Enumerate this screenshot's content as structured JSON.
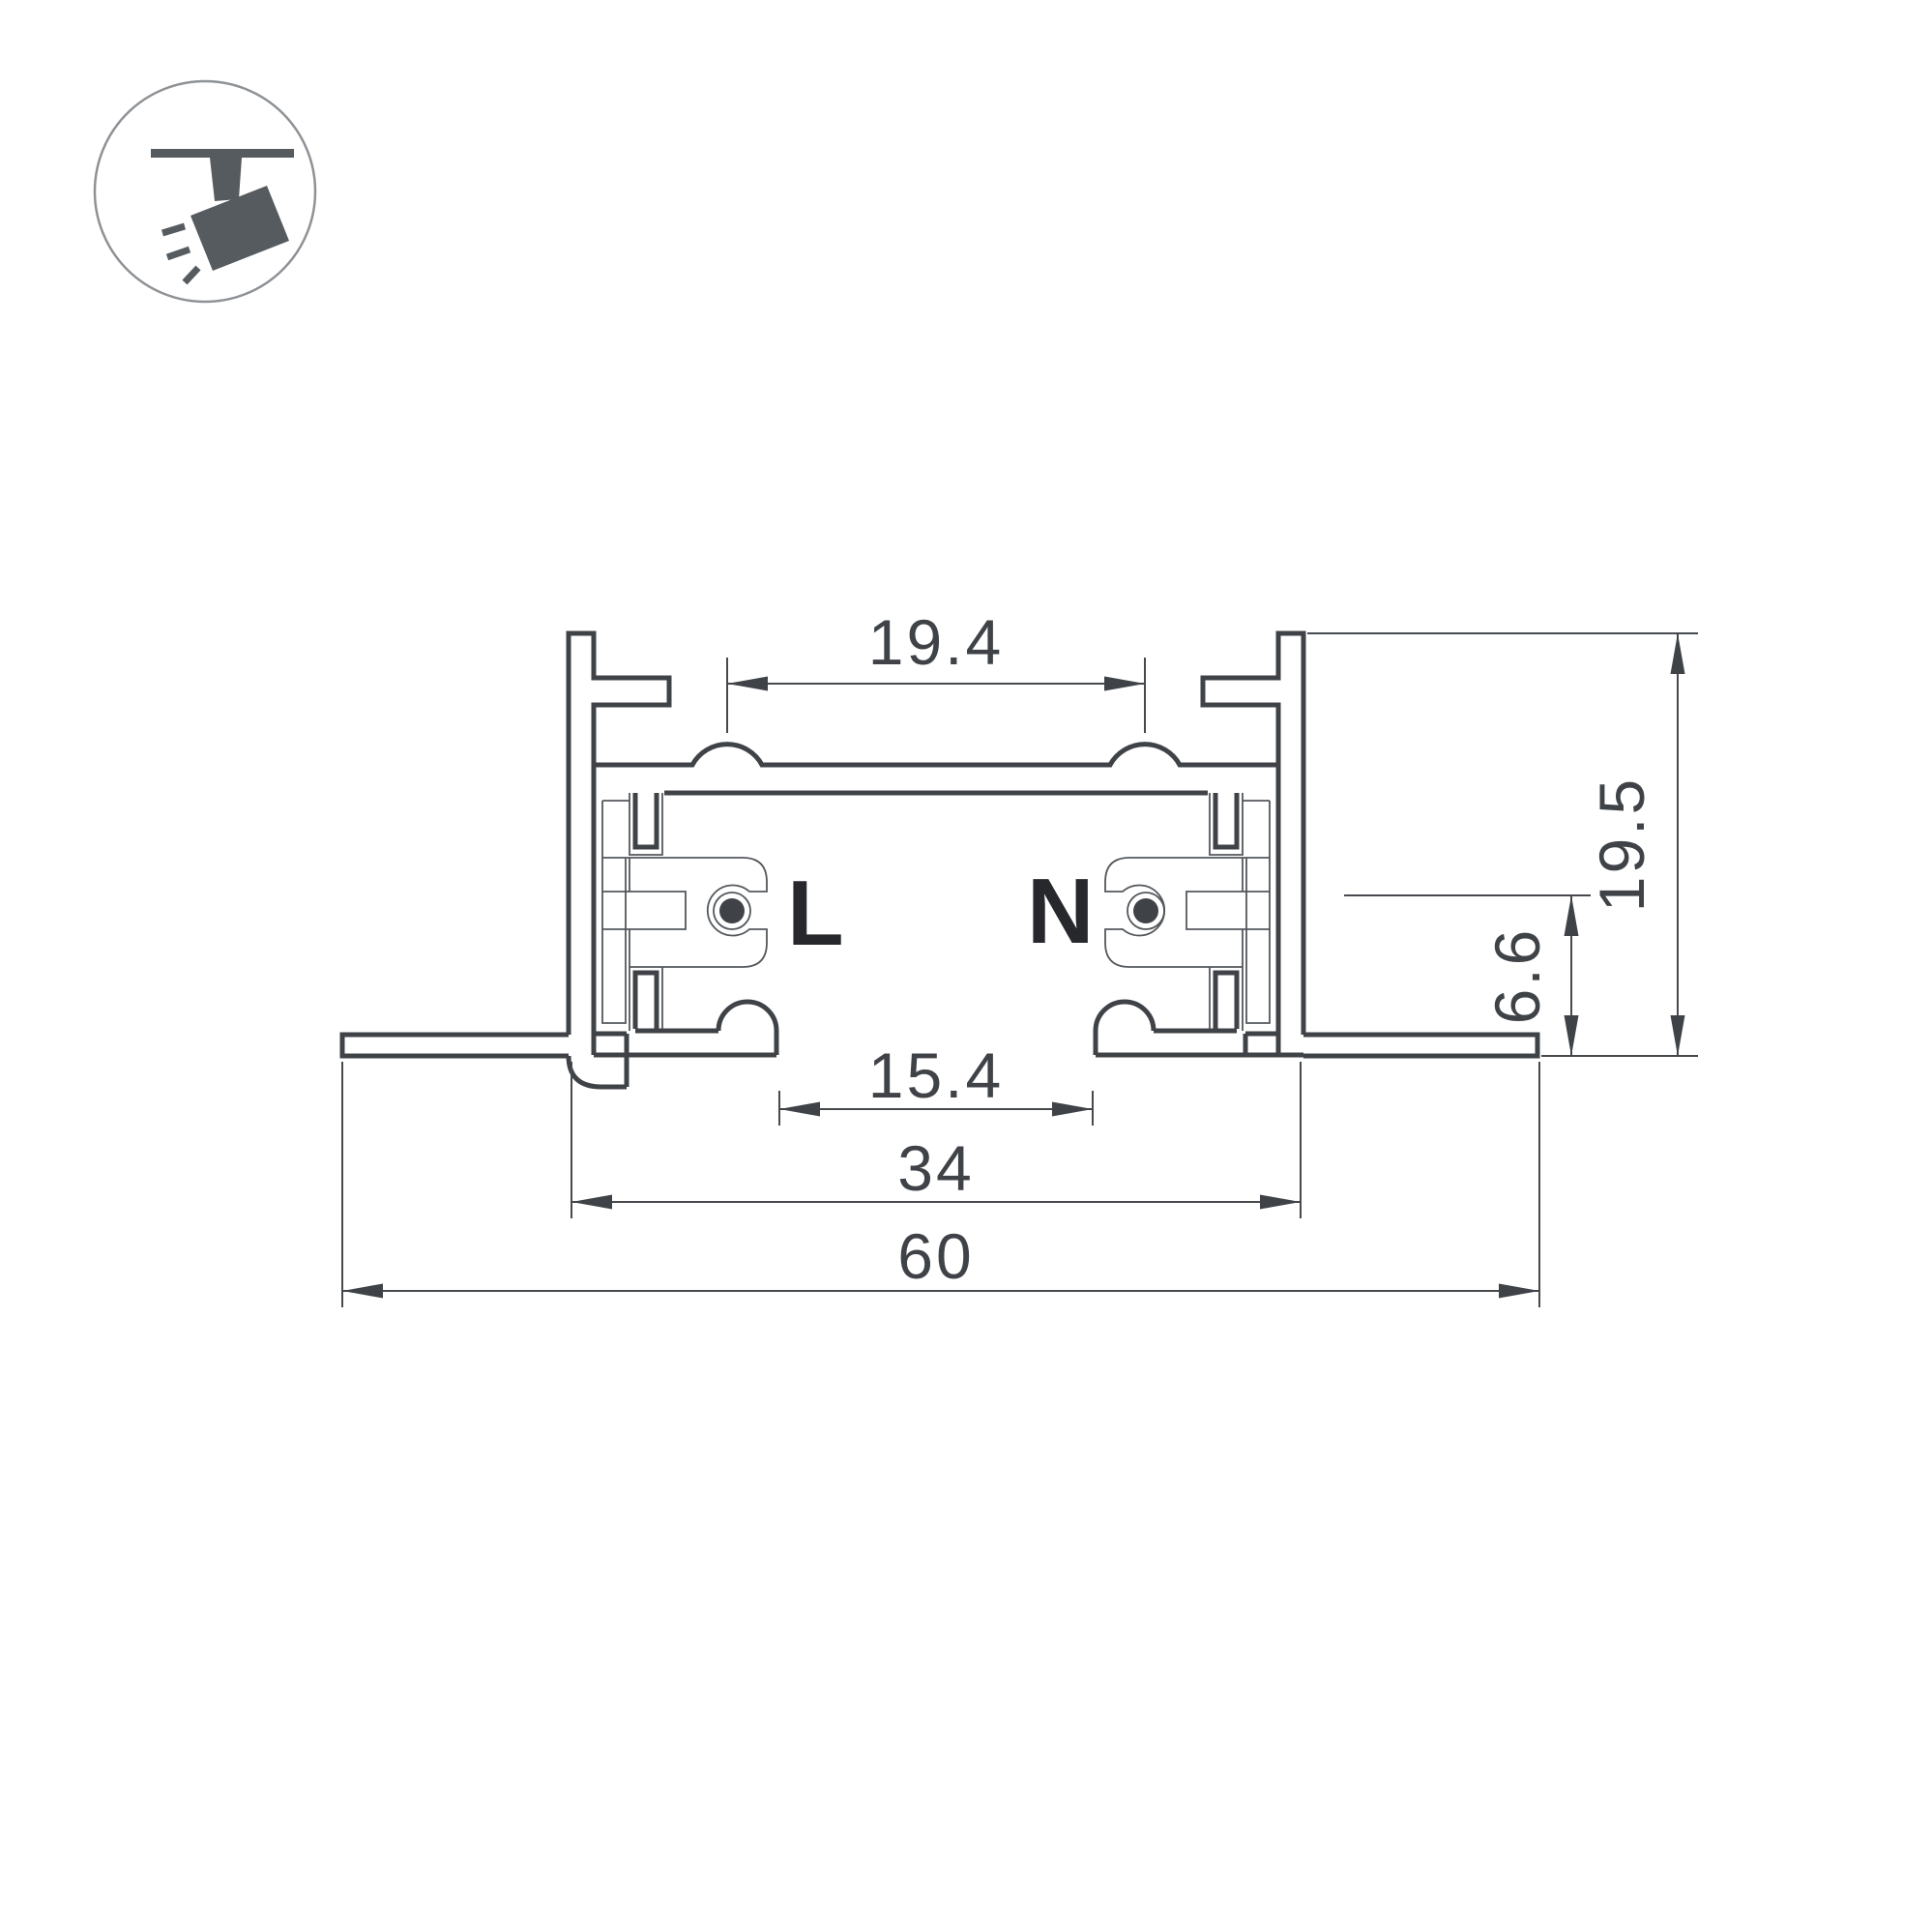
{
  "icon": {
    "name": "track-spotlight",
    "glyph_color": "#565b60",
    "ring_color": "#8e9296"
  },
  "profile": {
    "live_label": "L",
    "neutral_label": "N",
    "outline_color": "#3f4347",
    "detail_color": "#54585c",
    "label_color": "#26282c"
  },
  "dimensions": {
    "color": "#46494d",
    "top_opening": {
      "value": "19.4"
    },
    "total_height": {
      "value": "19.5"
    },
    "conductor_offset": {
      "value": "6.6"
    },
    "bottom_opening": {
      "value": "15.4"
    },
    "body_width": {
      "value": "34"
    },
    "total_width": {
      "value": "60"
    }
  }
}
